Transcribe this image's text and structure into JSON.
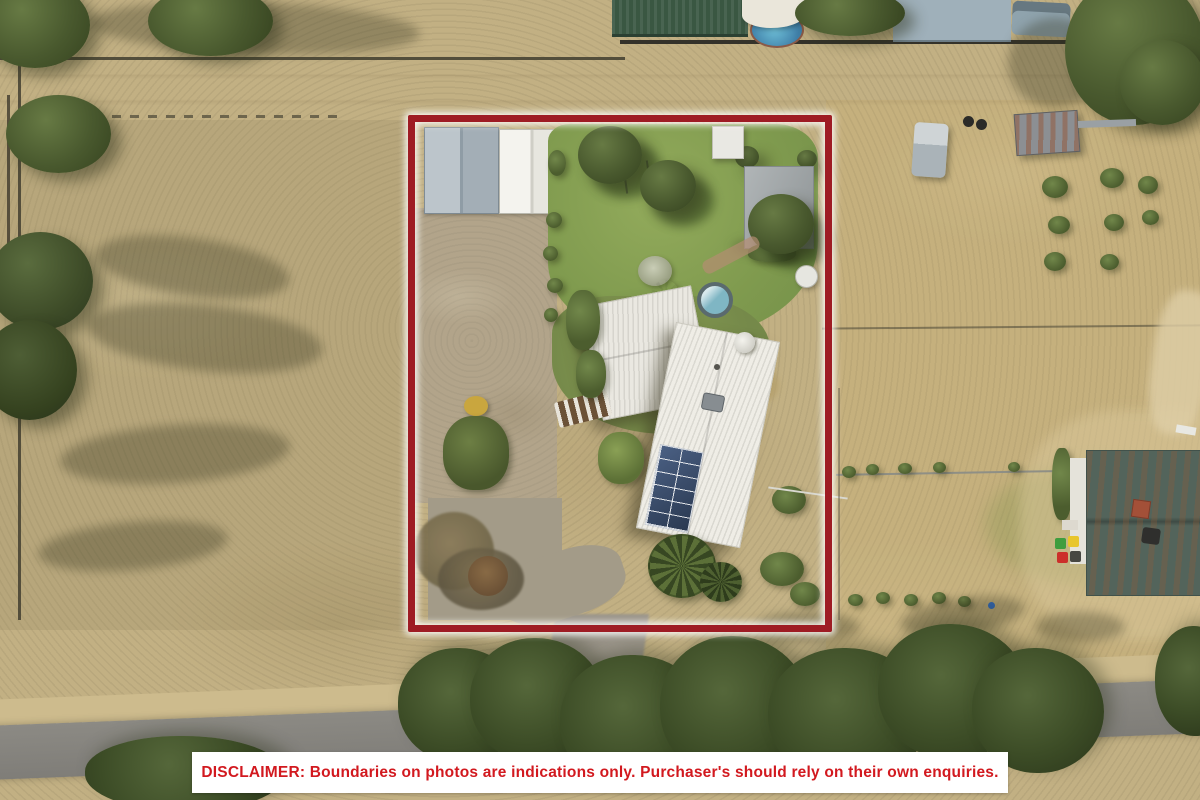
{
  "overlay": {
    "disclaimer_text": "DISCLAIMER: Boundaries on photos are indications only. Purchaser's should rely on their own enquiries.",
    "disclaimer_text_color": "#d2191f",
    "disclaimer_background": "#ffffff",
    "boundary_color": "#9e1c24",
    "boundary_glow_color": "#ffffff"
  },
  "scene": {
    "type": "aerial-drone-photograph",
    "features": [
      "dry grass paddocks",
      "gravel road along top",
      "sealed road along bottom with tree row",
      "subject property outlined in red rectangle",
      "grey and white gable sheds with gravel hardstand",
      "white corrugated-roof house with rooftop solar panels and satellite dish",
      "grey flat-roof carport pergola",
      "green lawn with trees",
      "curved gravel driveway to road",
      "round plunge pool and patio umbrella",
      "white water tank",
      "neighbouring house with rusted green roof, brick chimney and wheelie bins",
      "truck, trailer container and tyres in neighbouring yard",
      "scattered green shrubs on dry paddock"
    ]
  }
}
